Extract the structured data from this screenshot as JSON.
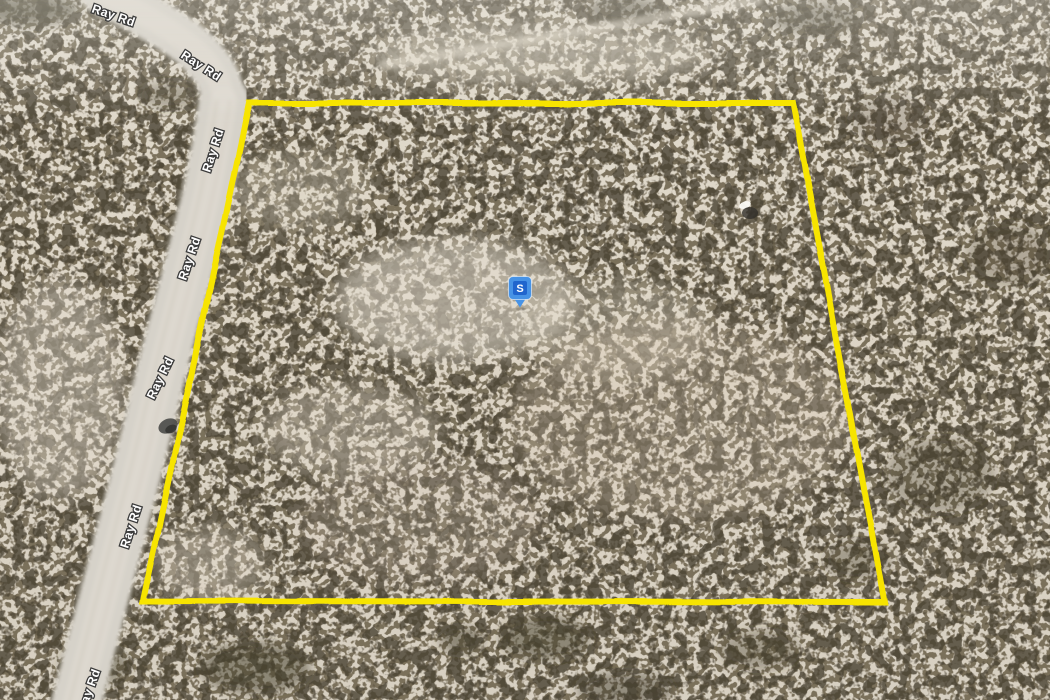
{
  "window": {
    "width_px": 1050,
    "height_px": 700
  },
  "map": {
    "type": "aerial-satellite-view",
    "scene": "Tilted satellite view of a desert land parcel outlined in yellow beside a dirt road named Ray Rd, with a blue pin marker at the parcel center",
    "road_name": "Ray Rd",
    "road_labels": [
      {
        "text": "Ray Rd",
        "x": 91,
        "y": 12,
        "rotation": 19
      },
      {
        "text": "Ray Rd",
        "x": 180,
        "y": 57,
        "rotation": 33
      },
      {
        "text": "Ray Rd",
        "x": 210,
        "y": 173,
        "rotation": -72
      },
      {
        "text": "Ray Rd",
        "x": 186,
        "y": 281,
        "rotation": -71
      },
      {
        "text": "Ray Rd",
        "x": 154,
        "y": 400,
        "rotation": -64
      },
      {
        "text": "Ray Rd",
        "x": 128,
        "y": 549,
        "rotation": -72
      },
      {
        "text": "Ray Rd",
        "x": 85,
        "y": 713,
        "rotation": -70
      }
    ],
    "parcel_boundary": {
      "color": "#f7e400",
      "stroke_width": 6,
      "points": [
        [
          249,
          103
        ],
        [
          793,
          103
        ],
        [
          885,
          602
        ],
        [
          143,
          601
        ]
      ]
    },
    "marker": {
      "letter": "S",
      "x": 520,
      "y": 288,
      "body_color": "#4793e6",
      "inner_color": "#2065cd"
    },
    "label_style": {
      "fill": "#ffffff",
      "halo": "#3b3b3b"
    }
  }
}
